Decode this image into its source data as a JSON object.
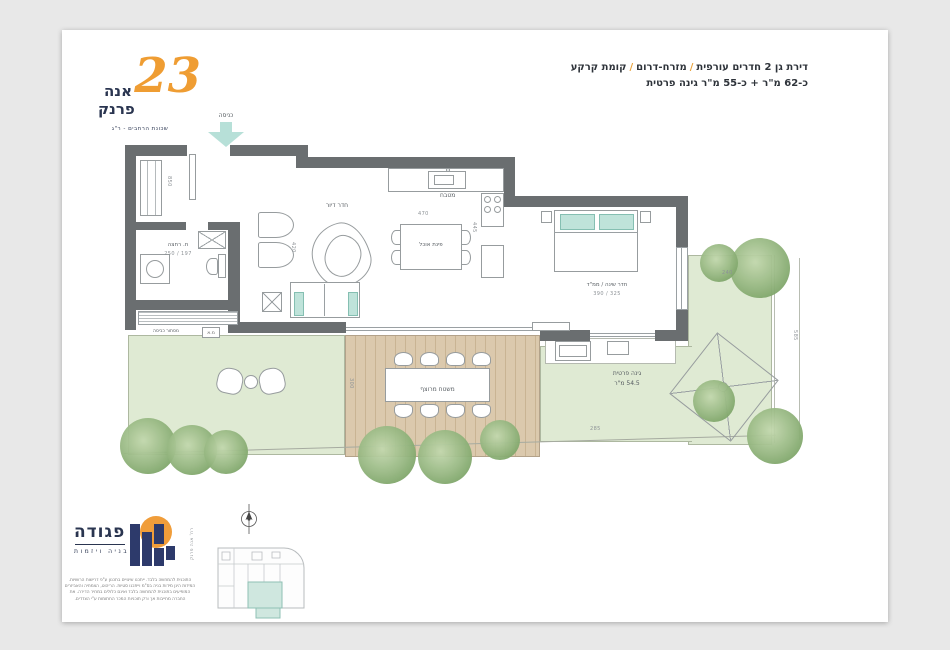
{
  "logo": {
    "number": "23",
    "name_top": "אנה",
    "name_bottom": "פרנק",
    "subtitle": "שכונת הרחבים - ר\"ג"
  },
  "header": {
    "seg1": "דירת גן 2 חדרים עורפית",
    "slash": "/",
    "seg2": "מזרח-דרום",
    "seg3": "קומת קרקע",
    "line2": "כ-62 מ\"ר + כ-55 מ\"ר גינה פרטית"
  },
  "plan": {
    "entrance_label": "כניסה",
    "dim_wall": "850",
    "bathroom": {
      "label": "ח. רחצה",
      "dims": "250 / 197"
    },
    "living": {
      "label": "חדר דיור",
      "dim": "420"
    },
    "dining": {
      "label": "פינת אוכל",
      "dim": "470"
    },
    "kitchen": {
      "label": "מטבח",
      "dim": "445"
    },
    "bedroom": {
      "label": "חדר שינה / ממ\"ד",
      "dims": "390 / 325"
    },
    "deck": {
      "label": "משטח מרוצף",
      "dim": "300"
    },
    "garden": {
      "label": "גינה פרטית",
      "area": "54.5 מ\"ר"
    },
    "laundry_label": "מסתור כביסה",
    "ac_label": "מ.א",
    "dim_garden_top": "240",
    "dim_garden_bottom": "285",
    "dim_garden_right": "585"
  },
  "keyplan": {
    "street": "רח' אנה פרנק"
  },
  "developer": {
    "name": "פגודה",
    "tagline": "בניה ויזמות"
  },
  "disclaimer": {
    "text": "התוכנית להמחשה בלבד. ייתכנו שינויים בתכנון ע\"פ דרישות הרשויות. המידות הינן מידות בניה בס\"מ וייתכנו סטיות. הריהוט, הצמחיה והאביזרים המופיעים בתוכנית להמחשה בלבד ואינם כלולים במחיר הדירה. את החברה מחייבות אך ורק תוכניות המכר החתומות ע\"י הצדדים."
  },
  "colors": {
    "accent_orange": "#ef9d33",
    "brand_navy": "#2a3550",
    "teal_accent": "#bfe3da",
    "garden_green": "#dfead3",
    "deck_tan": "#dbc9ad",
    "wall_gray": "#6a6e70"
  }
}
